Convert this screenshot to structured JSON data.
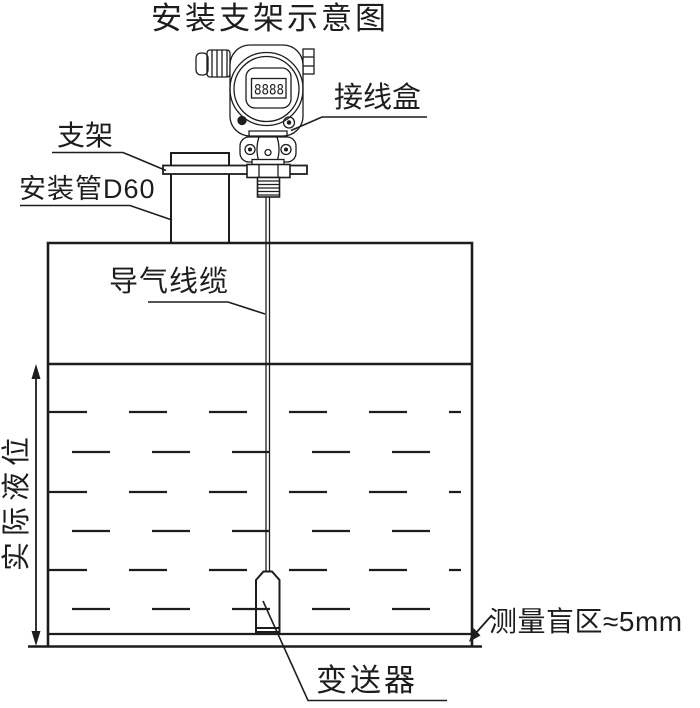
{
  "title": "安装支架示意图",
  "colors": {
    "ink": "#1d1d1d",
    "background": "#ffffff"
  },
  "device": {
    "display_value": "8888"
  },
  "labels": {
    "junction_box": "接线盒",
    "bracket": "支架",
    "mounting_pipe": "安装管D60",
    "air_cable": "导气线缆",
    "actual_level": "实际液位",
    "blind_zone": "测量盲区≈5mm",
    "transmitter": "变送器"
  }
}
